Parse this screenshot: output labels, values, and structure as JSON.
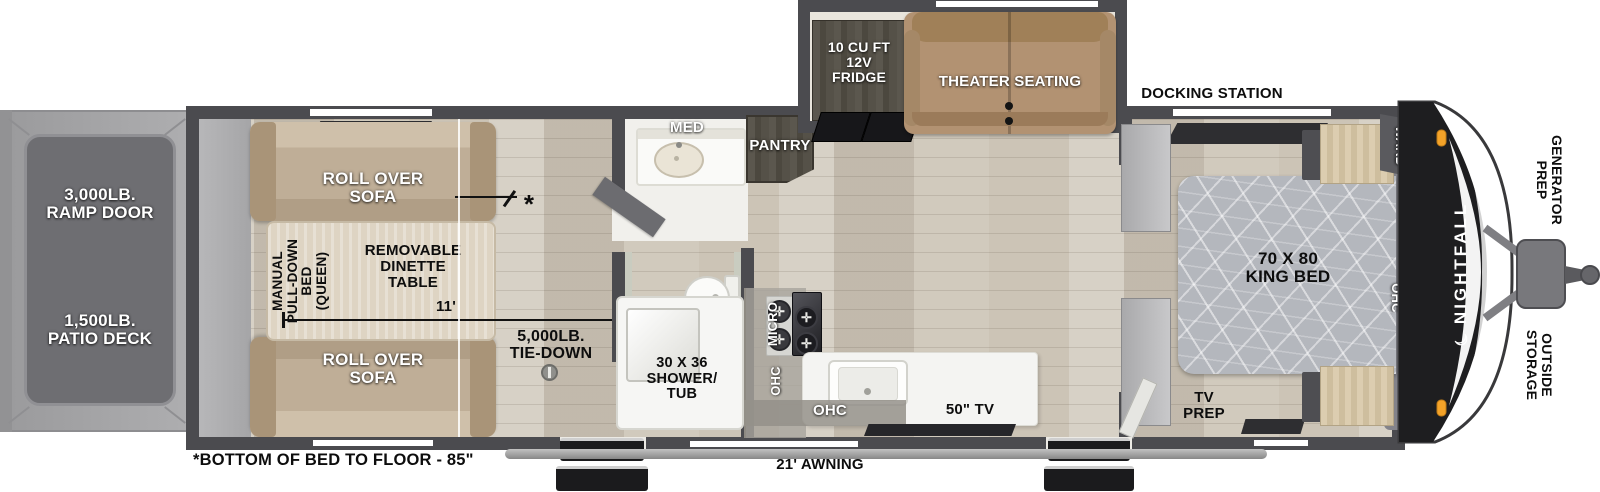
{
  "title": "Nightfall toy hauler travel trailer floor plan",
  "colors": {
    "wall": "#4b4b4f",
    "floor_wood": "#ccc4b6",
    "sofa_tan": "#bfae97",
    "theater_tan": "#b29272",
    "counter_white": "#f4f4f2",
    "bed_gray": "#b6b9bf",
    "front_cap_black": "#1e1e20",
    "marker_light_orange": "#f4a329",
    "deck_gray": "#6f6f73"
  },
  "exterior": {
    "ramp_door": "3,000LB.\nRAMP DOOR",
    "patio_deck": "1,500LB.\nPATIO DECK",
    "docking_station": "DOCKING STATION",
    "generator_prep": "GENERATOR\nPREP",
    "outside_storage": "OUTSIDE\nSTORAGE",
    "awning": "21' AWNING",
    "bed_height_note": "*BOTTOM OF BED TO FLOOR - 85\"",
    "brand": "NIGHTFALL",
    "brand_moon": "☾"
  },
  "garage": {
    "sofa_top": "ROLL OVER\nSOFA",
    "sofa_bottom": "ROLL OVER\nSOFA",
    "pulldown_bed": "MANUAL\nPULL-DOWN\nBED\n(QUEEN)",
    "dinette": "REMOVABLE\nDINETTE\nTABLE",
    "length_dim": "11'",
    "tie_down": "5,000LB.\nTIE-DOWN",
    "bed_height_marker": "*"
  },
  "bath": {
    "med": "MED",
    "shower": "30 X 36\nSHOWER/\nTUB"
  },
  "kitchen": {
    "pantry": "PANTRY",
    "micro": "MICRO",
    "ohc_left": "OHC",
    "ohc_bottom": "OHC",
    "tv": "50\" TV",
    "burner_glyph": "✛"
  },
  "slideout": {
    "fridge": "10 CU FT\n12V\nFRIDGE",
    "theater": "THEATER SEATING"
  },
  "bedroom": {
    "bed": "70 X 80\nKING BED",
    "ward": "WARD",
    "ohc": "OHC",
    "tv_prep": "TV\nPREP"
  }
}
